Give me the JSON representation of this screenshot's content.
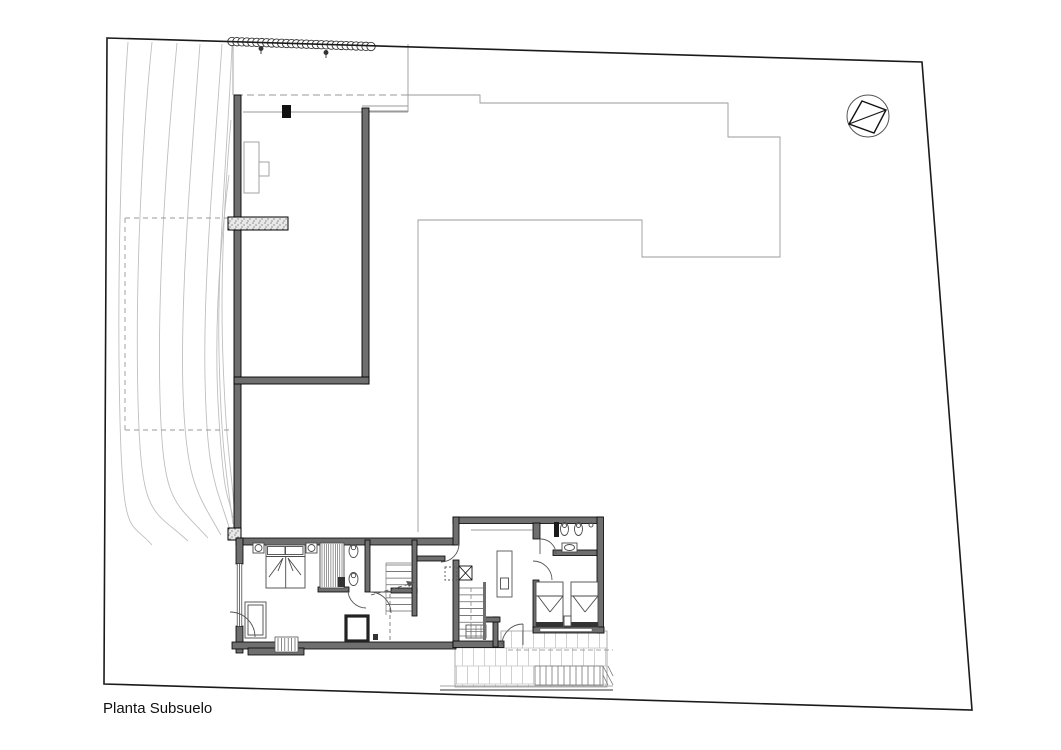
{
  "page": {
    "background": "#ffffff"
  },
  "titleblock": {
    "floor_label": "Planta Subsuelo"
  },
  "plan": {
    "type": "basement-floor-plan",
    "north_arrow_icon": "circle-with-triangle",
    "colors": {
      "boundary_line": "#1a1a1a",
      "wall_fill": "#6f6f6f",
      "secondary_line": "#9a9a9a",
      "contour_line": "#bfbfbf",
      "tile_line": "#c4c4c4"
    }
  }
}
